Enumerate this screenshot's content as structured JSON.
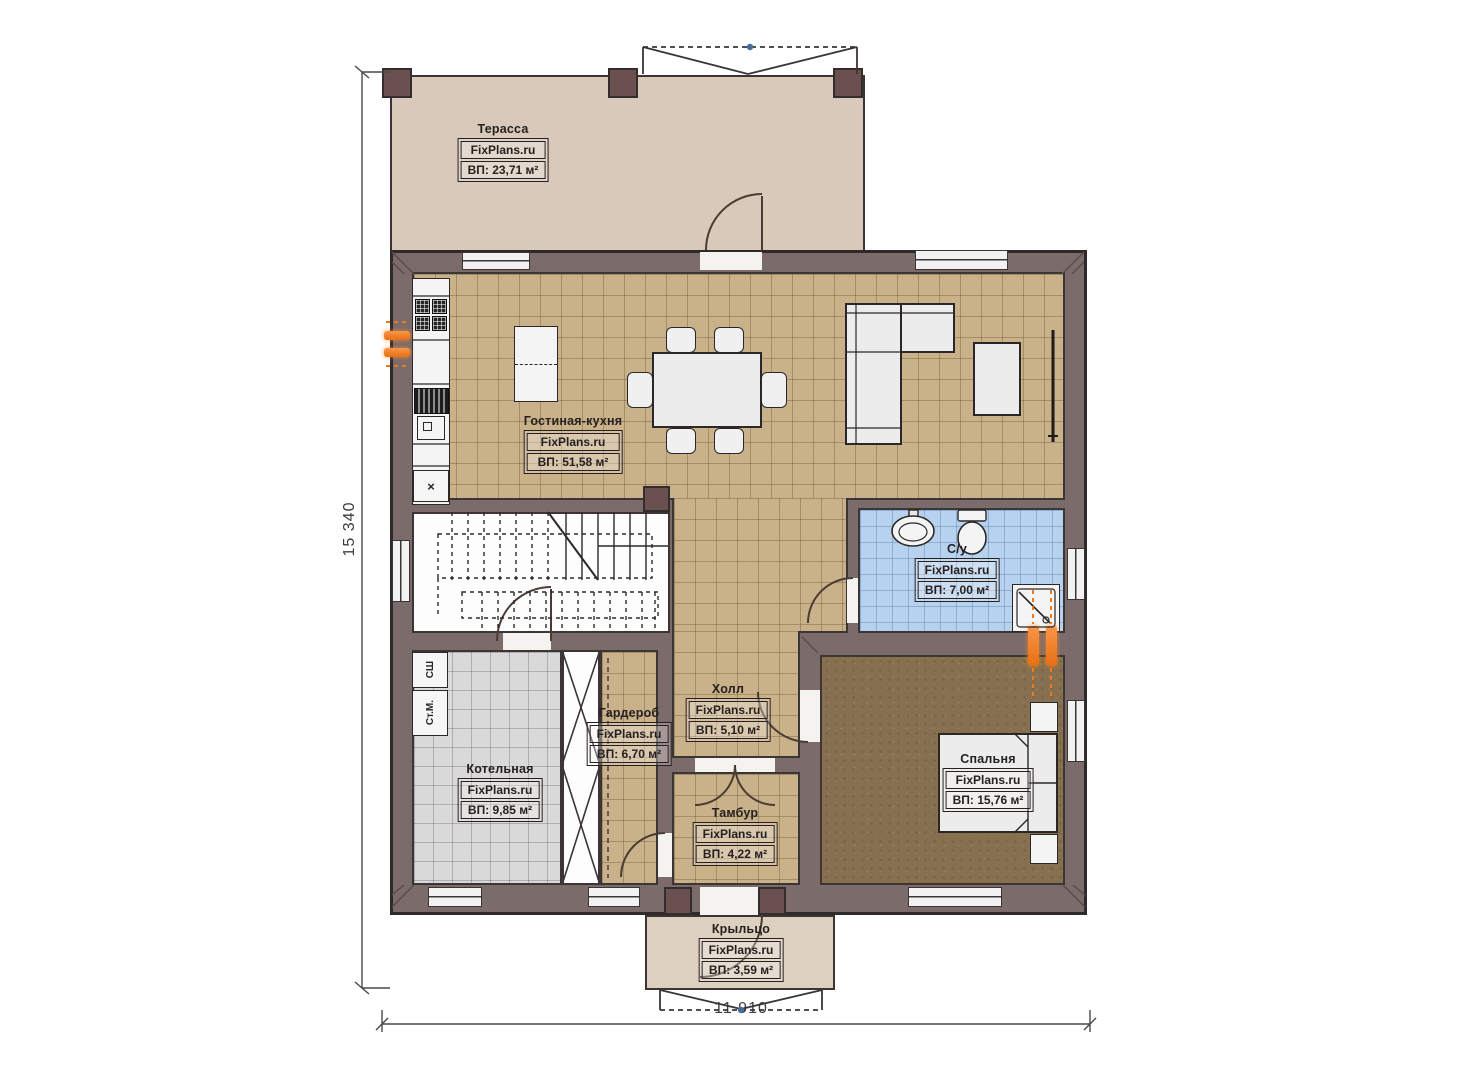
{
  "brand": "FixPlans.ru",
  "rooms": {
    "terrace": {
      "name": "Терасса",
      "area": "ВП: 23,71 м²"
    },
    "living": {
      "name": "Гостиная-кухня",
      "area": "ВП: 51,58 м²"
    },
    "bathroom": {
      "name": "С/у",
      "area": "ВП: 7,00 м²"
    },
    "hall": {
      "name": "Холл",
      "area": "ВП: 5,10 м²"
    },
    "wardrobe": {
      "name": "Гардероб",
      "area": "ВП: 6,70 м²"
    },
    "boiler": {
      "name": "Котельная",
      "area": "ВП: 9,85 м²"
    },
    "tambour": {
      "name": "Тамбур",
      "area": "ВП: 4,22 м²"
    },
    "bedroom": {
      "name": "Спальня",
      "area": "ВП: 15,76 м²"
    },
    "porch": {
      "name": "Крыльцо",
      "area": "ВП: 3,59 м²"
    }
  },
  "dimensions": {
    "vertical": "15 340",
    "horizontal": "11 910"
  },
  "appliances": {
    "dryer_label": "СШ",
    "washer_label": "Ст.М.",
    "fridge_label": "×"
  },
  "colors": {
    "wall": "#7c6b6b",
    "terrace": "#d8c9ba",
    "porch": "#dcd0bf",
    "floor_tan": "#c9b189",
    "floor_blue": "#b7d2ee",
    "floor_gray": "#d9d9d9",
    "floor_brown": "#86704f",
    "radiator": "#ee7b1f",
    "outline": "#3c3535"
  }
}
